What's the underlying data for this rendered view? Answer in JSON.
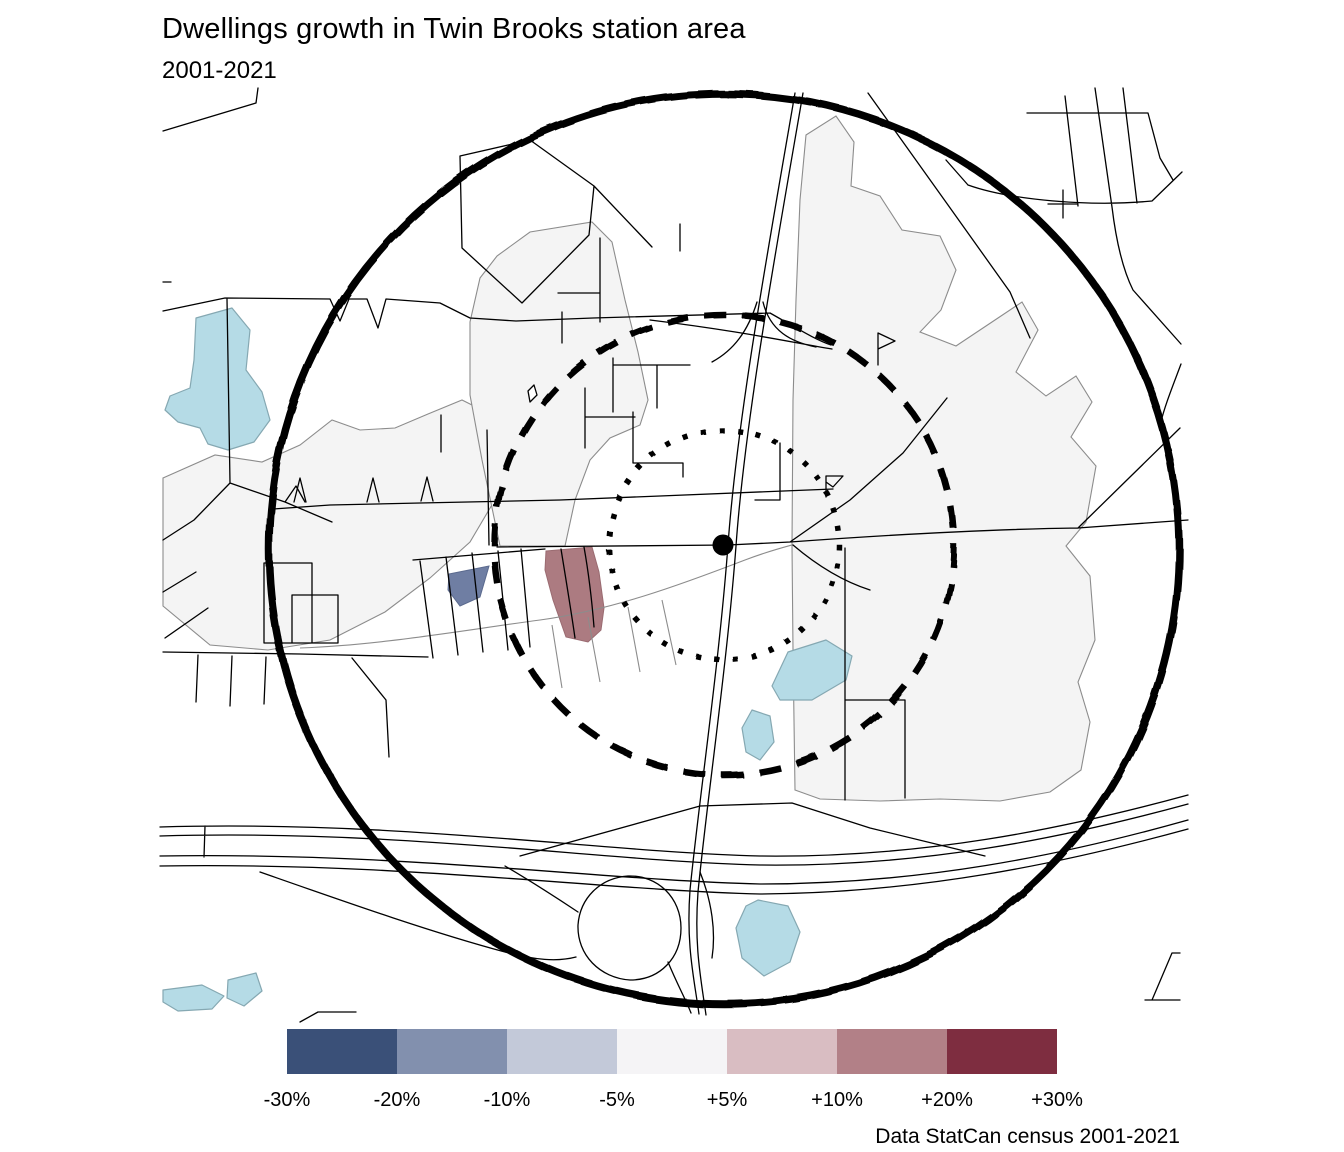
{
  "header": {
    "title": "Dwellings growth in Twin Brooks station area",
    "subtitle": "2001-2021"
  },
  "caption": "Data StatCan census 2001-2021",
  "legend": {
    "breaks": [
      "-30%",
      "-20%",
      "-10%",
      "-5%",
      "+5%",
      "+10%",
      "+20%",
      "+30%"
    ],
    "colors": [
      "#3A5078",
      "#8290AE",
      "#C3C9D9",
      "#F5F4F6",
      "#D9BDC2",
      "#B28087",
      "#7E2D40"
    ]
  },
  "map": {
    "colors": {
      "water": "#B5DBE6",
      "water_outline": "#85A8B2",
      "tract_fill": "#F4F4F4",
      "tract_outline": "#8C8C8C",
      "road": "#000000",
      "ring": "#000000",
      "declining_tract": "#6F7EA3",
      "growing_tract": "#AC7B81"
    },
    "rings": {
      "outer_style": "solid",
      "middle_style": "dashed",
      "inner_style": "dotted"
    }
  }
}
